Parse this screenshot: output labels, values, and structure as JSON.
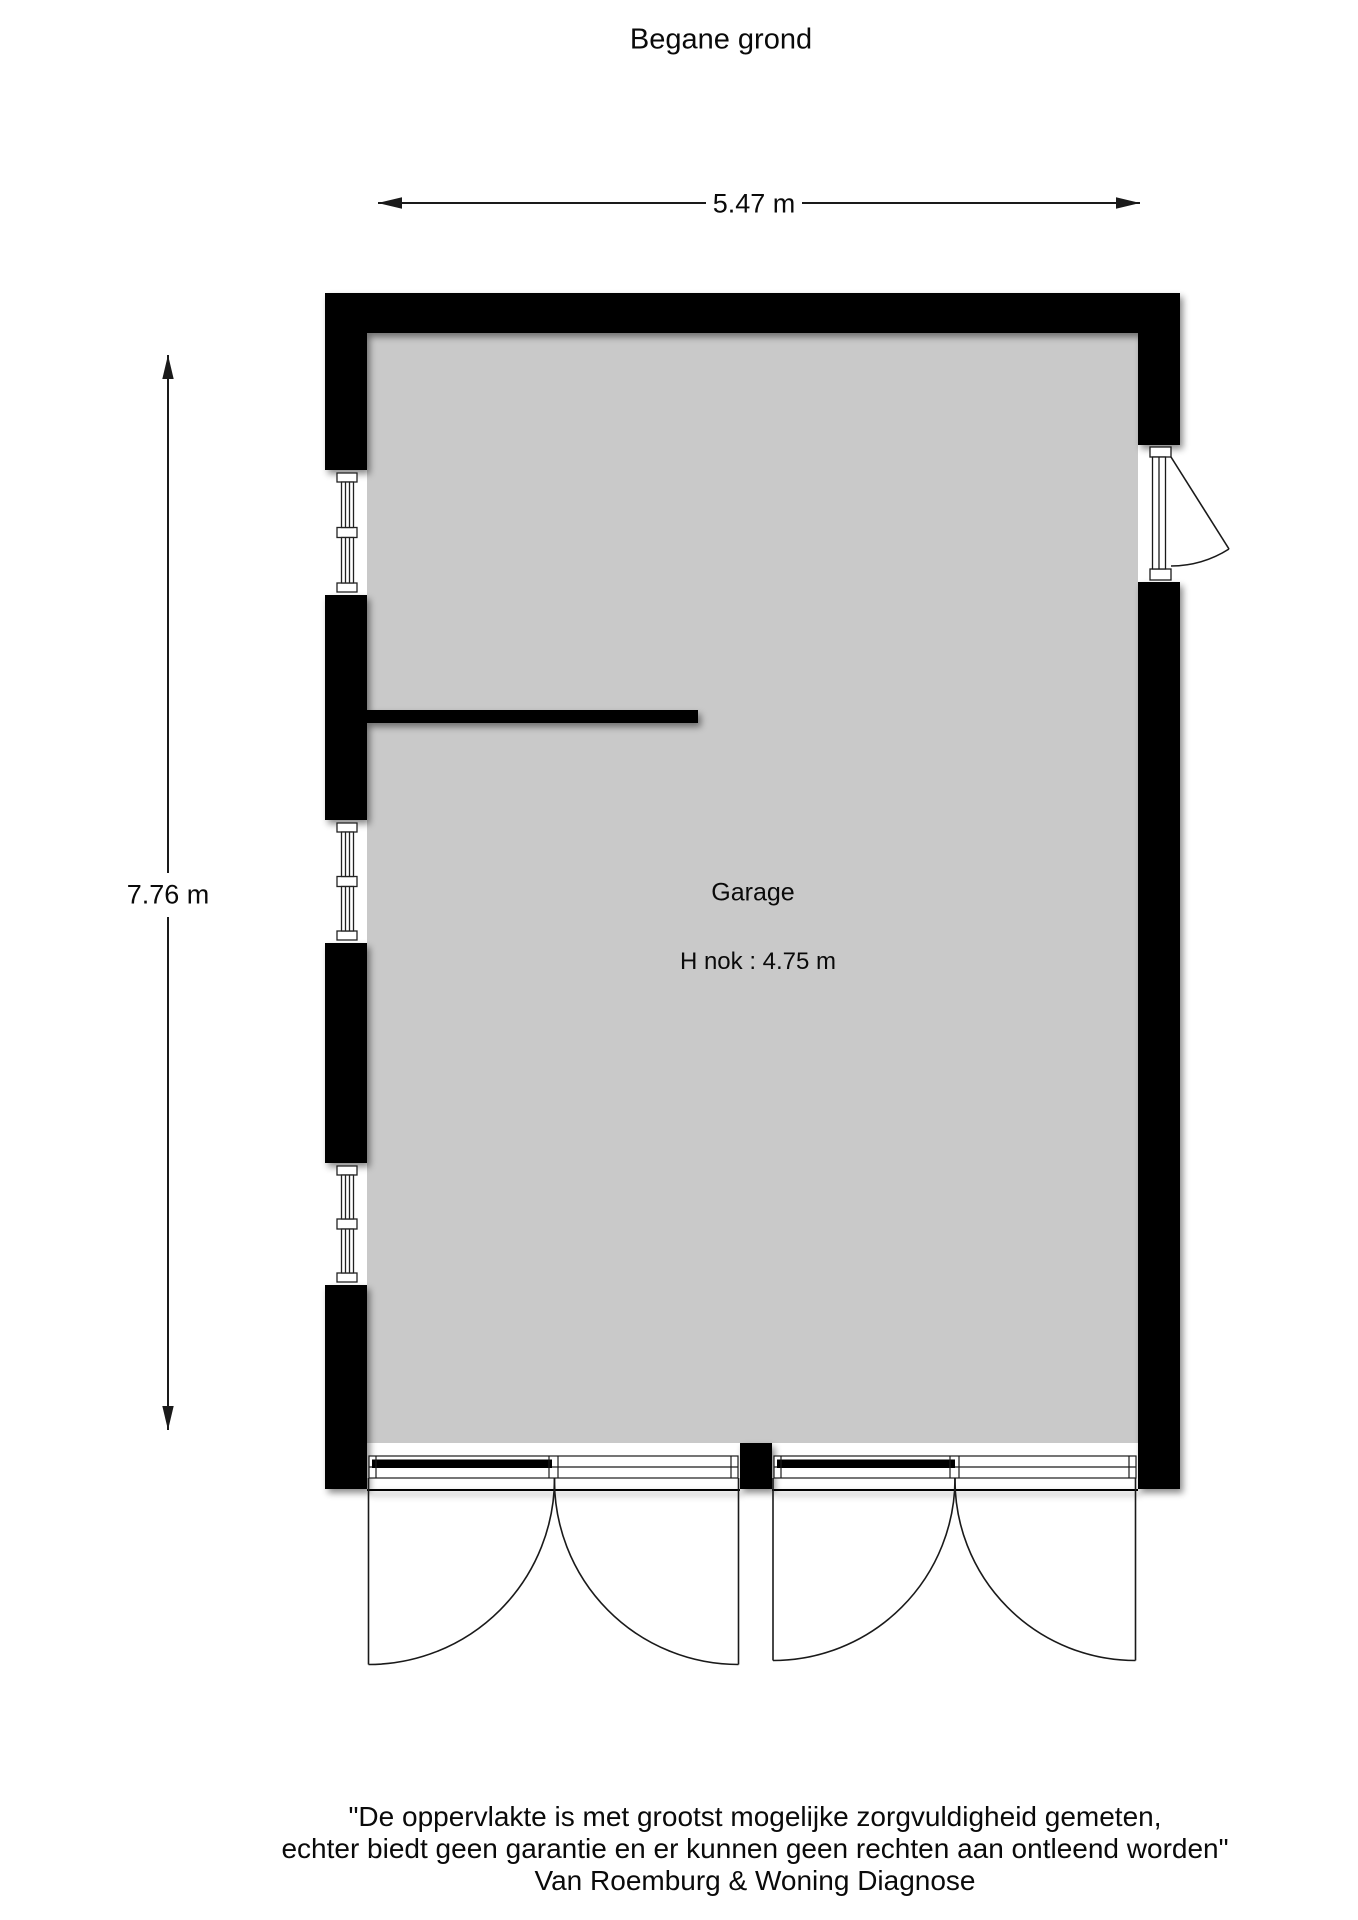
{
  "title": "Begane grond",
  "dimensions": {
    "width": "5.47 m",
    "height": "7.76 m"
  },
  "room": {
    "name": "Garage",
    "height_note": "H nok : 4.75 m"
  },
  "disclaimer": {
    "line1": "\"De oppervlakte is met grootst mogelijke zorgvuldigheid gemeten,",
    "line2": "echter biedt geen garantie en er kunnen geen rechten aan ontleend worden\"",
    "line3": "Van Roemburg & Woning Diagnose"
  },
  "plan": {
    "floor": "Begane grond",
    "rooms": [
      "Garage"
    ],
    "left_wall_window_count": 3,
    "right_wall_door": "single door, swings outward",
    "bottom_wall_doors": "two double garage doors, swing outward"
  },
  "colors": {
    "wall": "#000000",
    "floor": "#c9c9c9",
    "line": "#1a1a1a",
    "text": "#0a0a0a"
  }
}
